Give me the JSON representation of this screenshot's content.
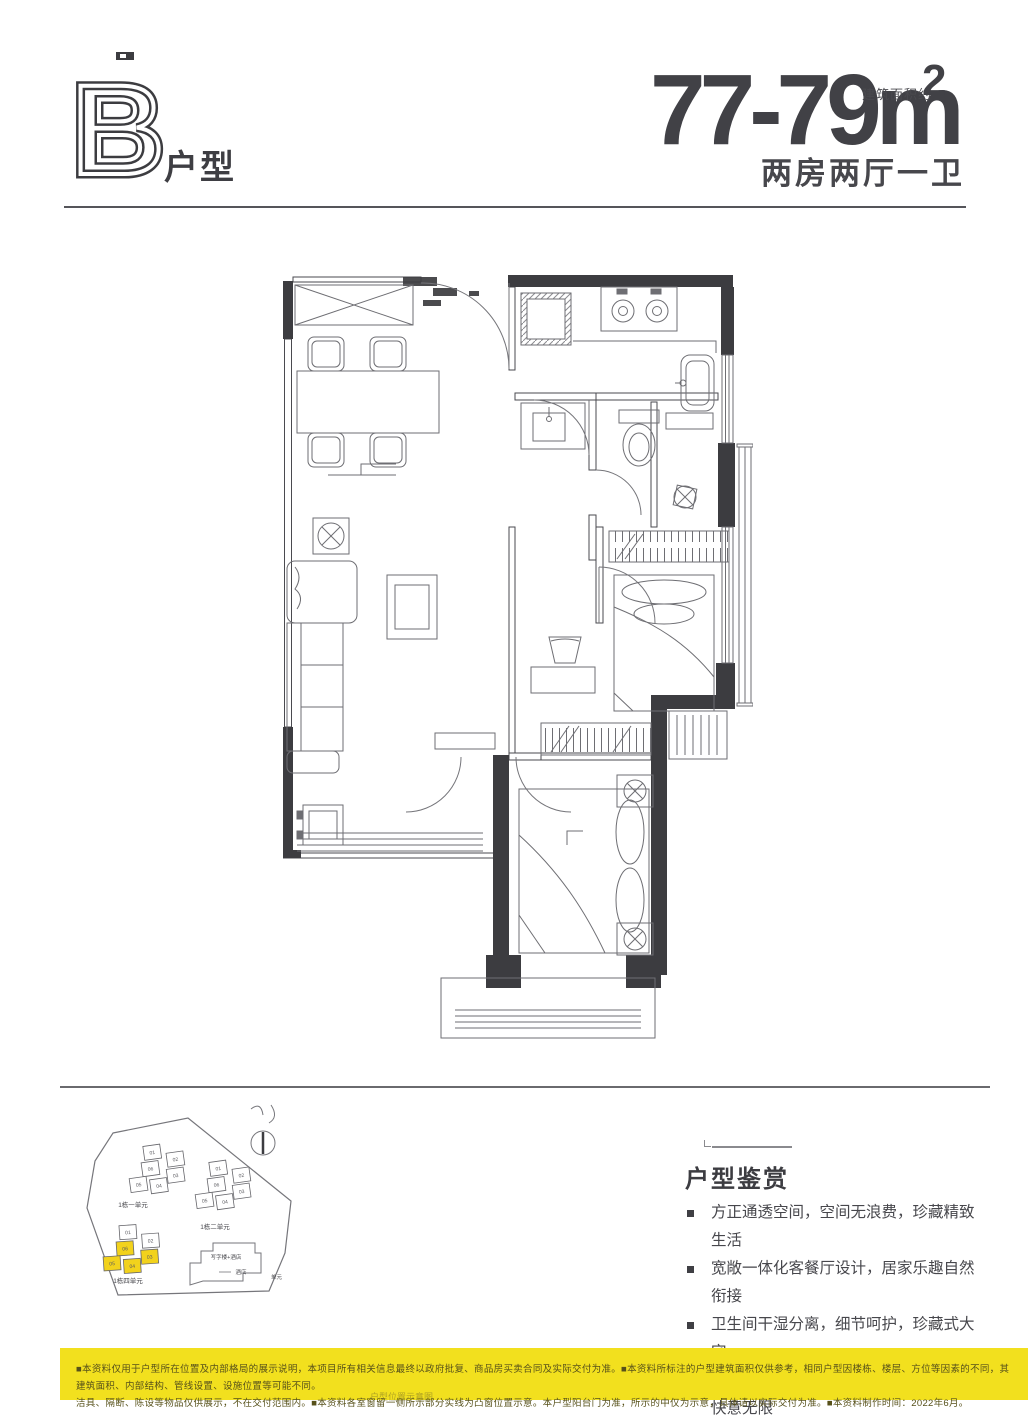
{
  "header": {
    "unit_letter": "B",
    "unit_type_label": "户型",
    "area_range": "77-79",
    "area_unit": "m",
    "area_sup": "2",
    "area_note": "建筑面积约",
    "subtitle": "两房两厅一卫"
  },
  "appreciation": {
    "title": "户型鉴赏",
    "bullets": [
      "方正通透空间，空间无浪费，珍藏精致生活",
      "宽敞一体化客餐厅设计，居家乐趣自然衔接",
      "卫生间干湿分离，细节呵护，珍藏式大宅",
      "卧室双面采光，自然光惬意入室，生活快意无限"
    ]
  },
  "site_plan": {
    "cluster1_label": "1栋一单元",
    "cluster2_label": "1栋二单元",
    "cluster4_label": "1栋四单元",
    "office_label": "写字楼+酒店",
    "hotel_label": "酒店",
    "unit_side_label": "单元",
    "unit_labels": [
      "01",
      "02",
      "03",
      "04",
      "05",
      "06"
    ],
    "highlight_color": "#F2D21C"
  },
  "disclaimer": {
    "line1": "■本资料仅用于户型所在位置及内部格局的展示说明，本项目所有相关信息最终以政府批复、商品房买卖合同及实际交付为准。■本资料所标注的户型建筑面积仅供参考，相同户型因楼栋、楼层、方位等因素的不同，其建筑面积、内部结构、管线设置、设施位置等可能不同。",
    "line2": "洁具、隔断、陈设等物品仅供展示，不在交付范围内。■本资料各室窗留一侧所示部分实线为凸窗位置示意。本户型阳台门为准，所示的中仅为示意，具体请以实际交付为准。■本资料制作时间：2022年6月。",
    "watermark": "户型位置示意图"
  },
  "colors": {
    "wall": "#3c3c40",
    "accent_yellow": "#F2E01E",
    "text_dark": "#3f3f44"
  }
}
